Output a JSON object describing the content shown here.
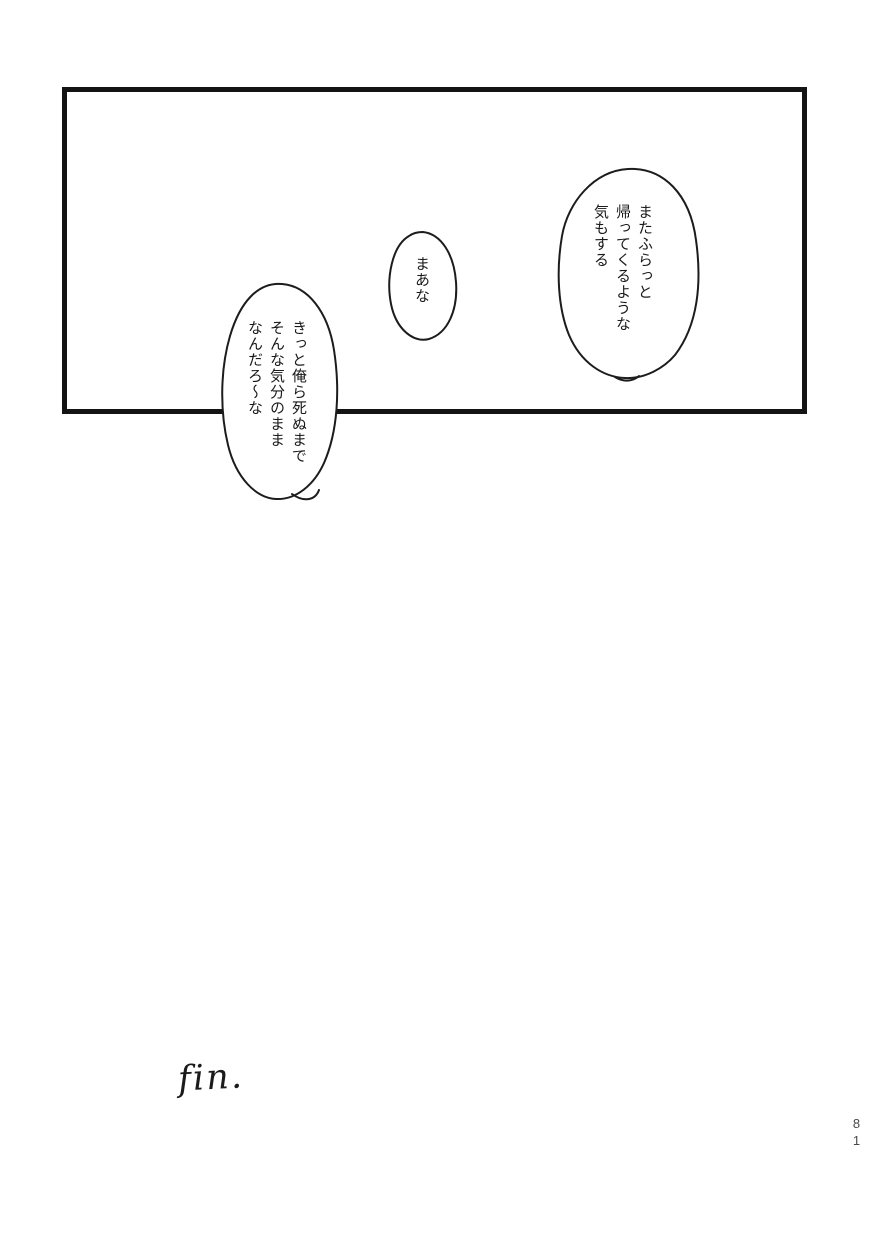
{
  "page": {
    "type_label": "manga-page"
  },
  "bubbles": [
    {
      "id": "bubble-top-right",
      "text": "またふらっと\n帰ってくるような\n気もする"
    },
    {
      "id": "bubble-middle",
      "text": "まあな"
    },
    {
      "id": "bubble-bottom-left",
      "text": "きっと俺ら死ぬまで\nそんな気分のまま\nなんだろ〜な"
    }
  ],
  "footer": {
    "fin_label": "fin.",
    "page_number": "81"
  }
}
